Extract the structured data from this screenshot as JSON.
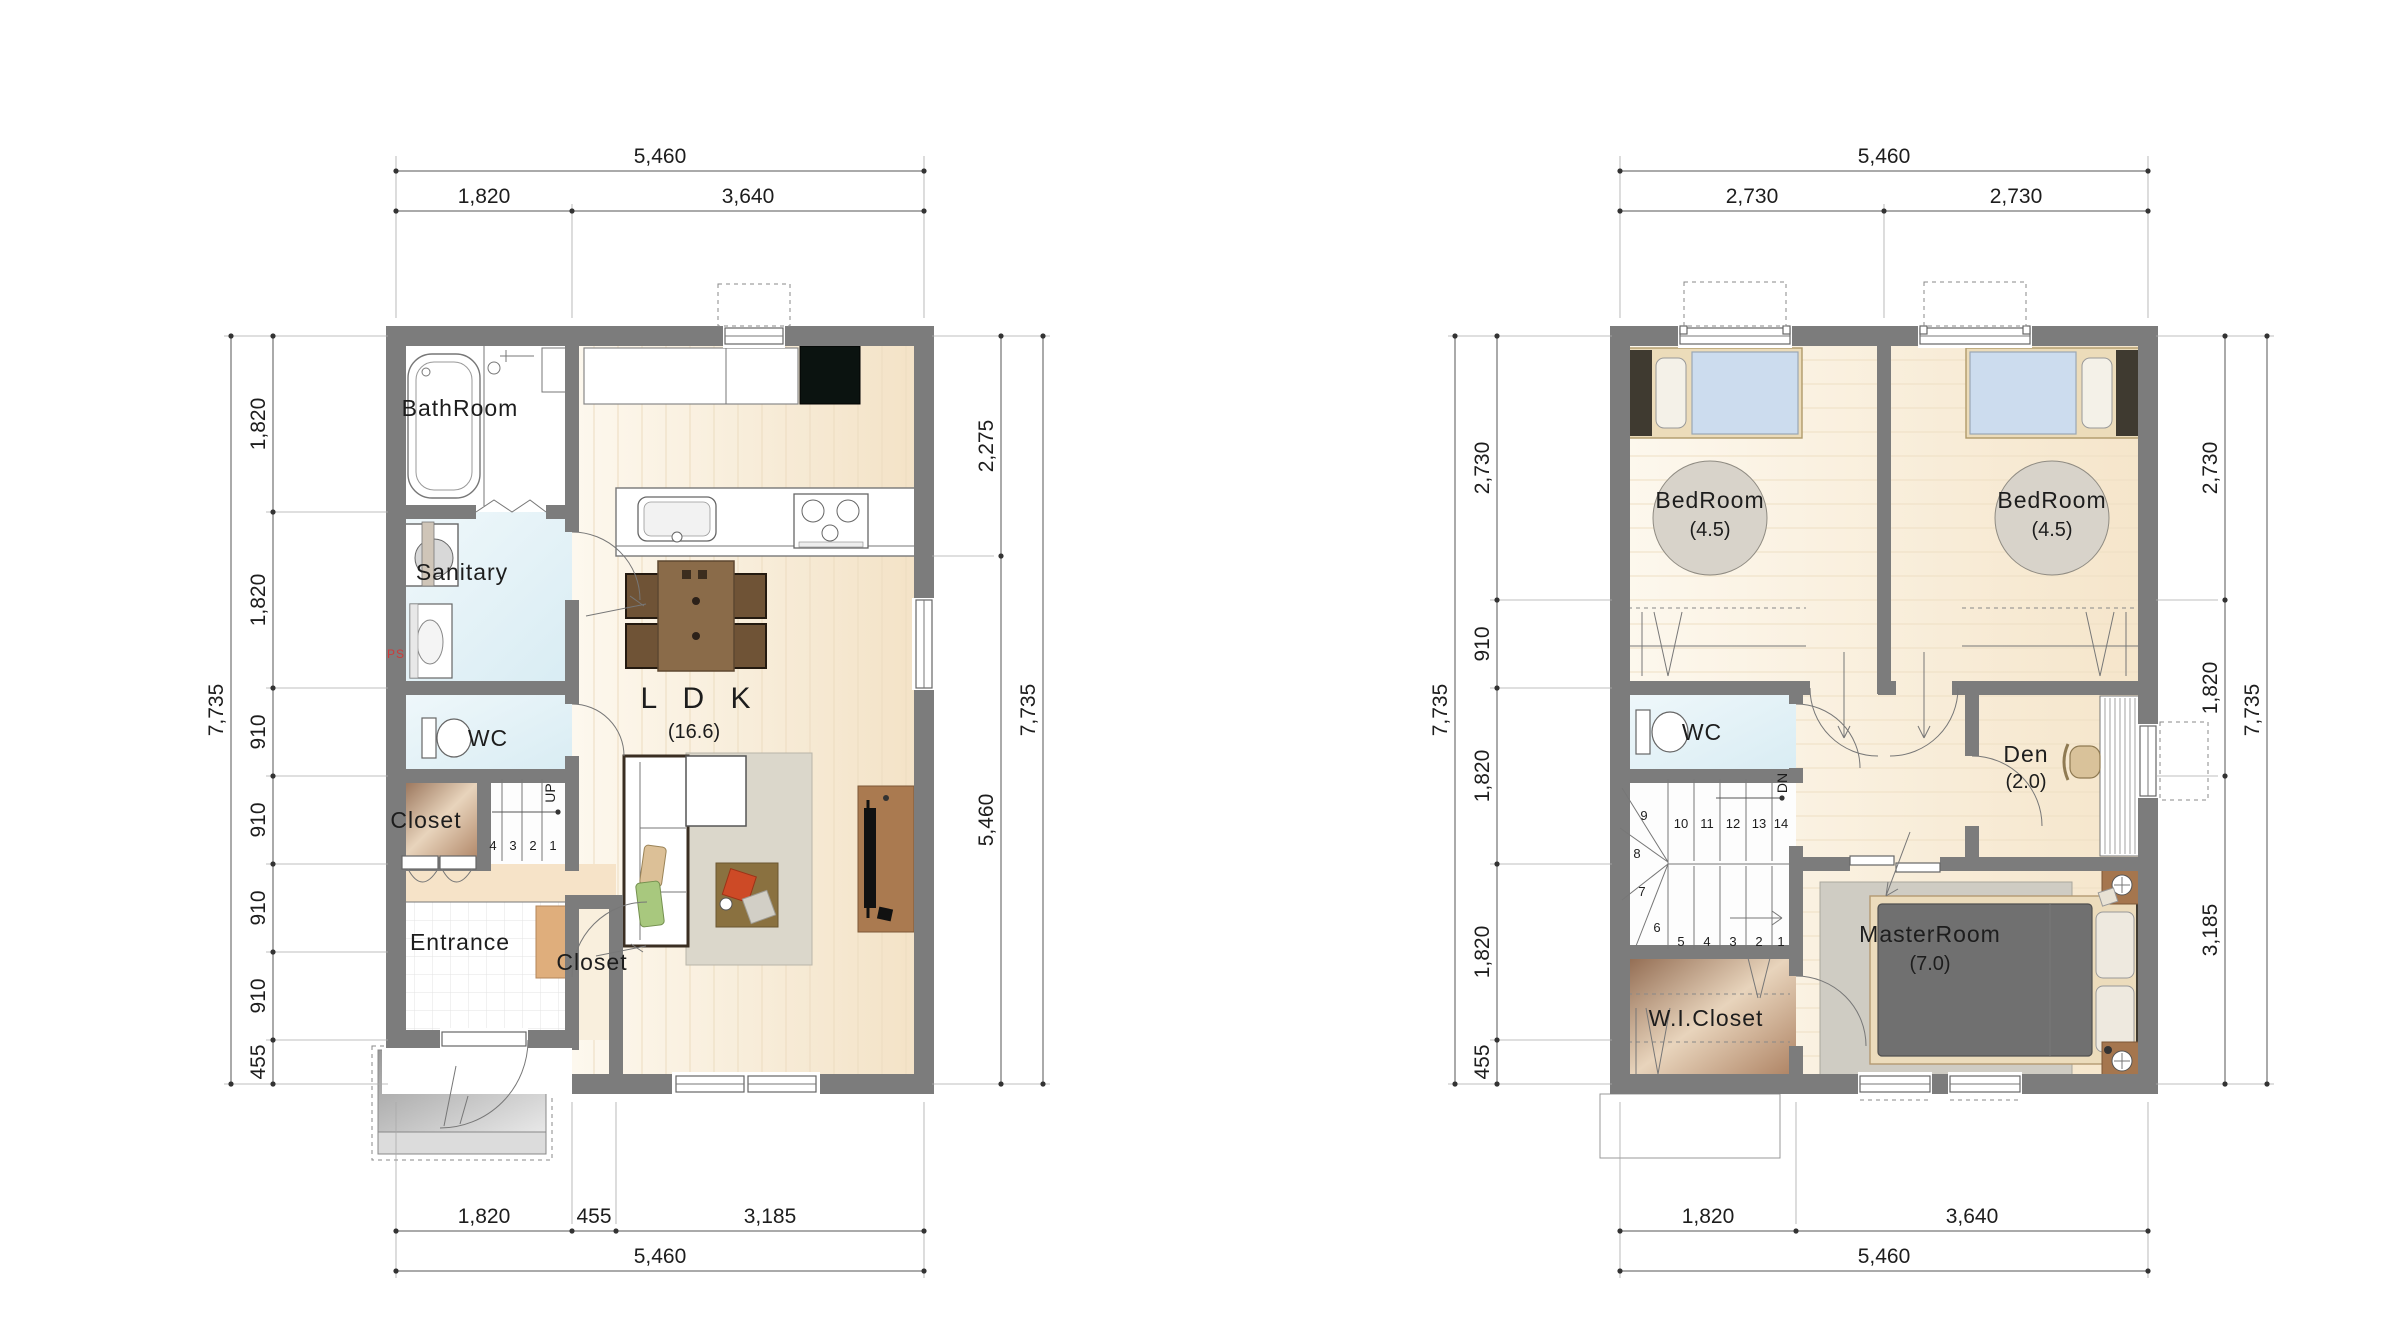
{
  "colors": {
    "wall": "#7c7c7c",
    "floor_wood": "#f6e9d2",
    "wet_blue": "#e4f0f6",
    "closet_brown": "#9b7054",
    "porch_gray": "#b5b5b5",
    "ps_red": "#cc3b3b"
  },
  "floor1": {
    "rooms": {
      "bathroom": "BathRoom",
      "sanitary": "Sanitary",
      "ps": "PS",
      "wc": "WC",
      "closet_hall": "Closet",
      "entrance": "Entrance",
      "closet_entry": "Closet",
      "ldk": "L D K",
      "ldk_size": "(16.6)"
    },
    "stairs": {
      "up": "UP",
      "nums": [
        "4",
        "3",
        "2",
        "1"
      ]
    },
    "dims": {
      "top_total": "5,460",
      "top_segs": [
        "1,820",
        "3,640"
      ],
      "left_total": "7,735",
      "left_segs": [
        "1,820",
        "1,820",
        "910",
        "910",
        "910",
        "910",
        "455"
      ],
      "right_segs": [
        "2,275",
        "5,460"
      ],
      "right_total": "7,735",
      "bottom_segs": [
        "1,820",
        "455",
        "3,185"
      ],
      "bottom_total": "5,460"
    }
  },
  "floor2": {
    "rooms": {
      "bedroom1": "BedRoom",
      "bedroom1_size": "(4.5)",
      "bedroom2": "BedRoom",
      "bedroom2_size": "(4.5)",
      "wc": "WC",
      "den": "Den",
      "den_size": "(2.0)",
      "wic": "W.I.Closet",
      "master": "MasterRoom",
      "master_size": "(7.0)"
    },
    "stairs": {
      "dn": "DN",
      "top_nums": [
        "10",
        "11",
        "12",
        "13",
        "14"
      ],
      "winder_nums": [
        "9",
        "8",
        "7",
        "6"
      ],
      "bottom_nums": [
        "5",
        "4",
        "3",
        "2",
        "1"
      ]
    },
    "dims": {
      "top_total": "5,460",
      "top_segs": [
        "2,730",
        "2,730"
      ],
      "left_total": "7,735",
      "left_segs": [
        "2,730",
        "910",
        "1,820",
        "1,820",
        "455"
      ],
      "right_segs": [
        "2,730",
        "1,820",
        "3,185"
      ],
      "right_total": "7,735",
      "bottom_segs": [
        "1,820",
        "3,640"
      ],
      "bottom_total": "5,460"
    }
  }
}
